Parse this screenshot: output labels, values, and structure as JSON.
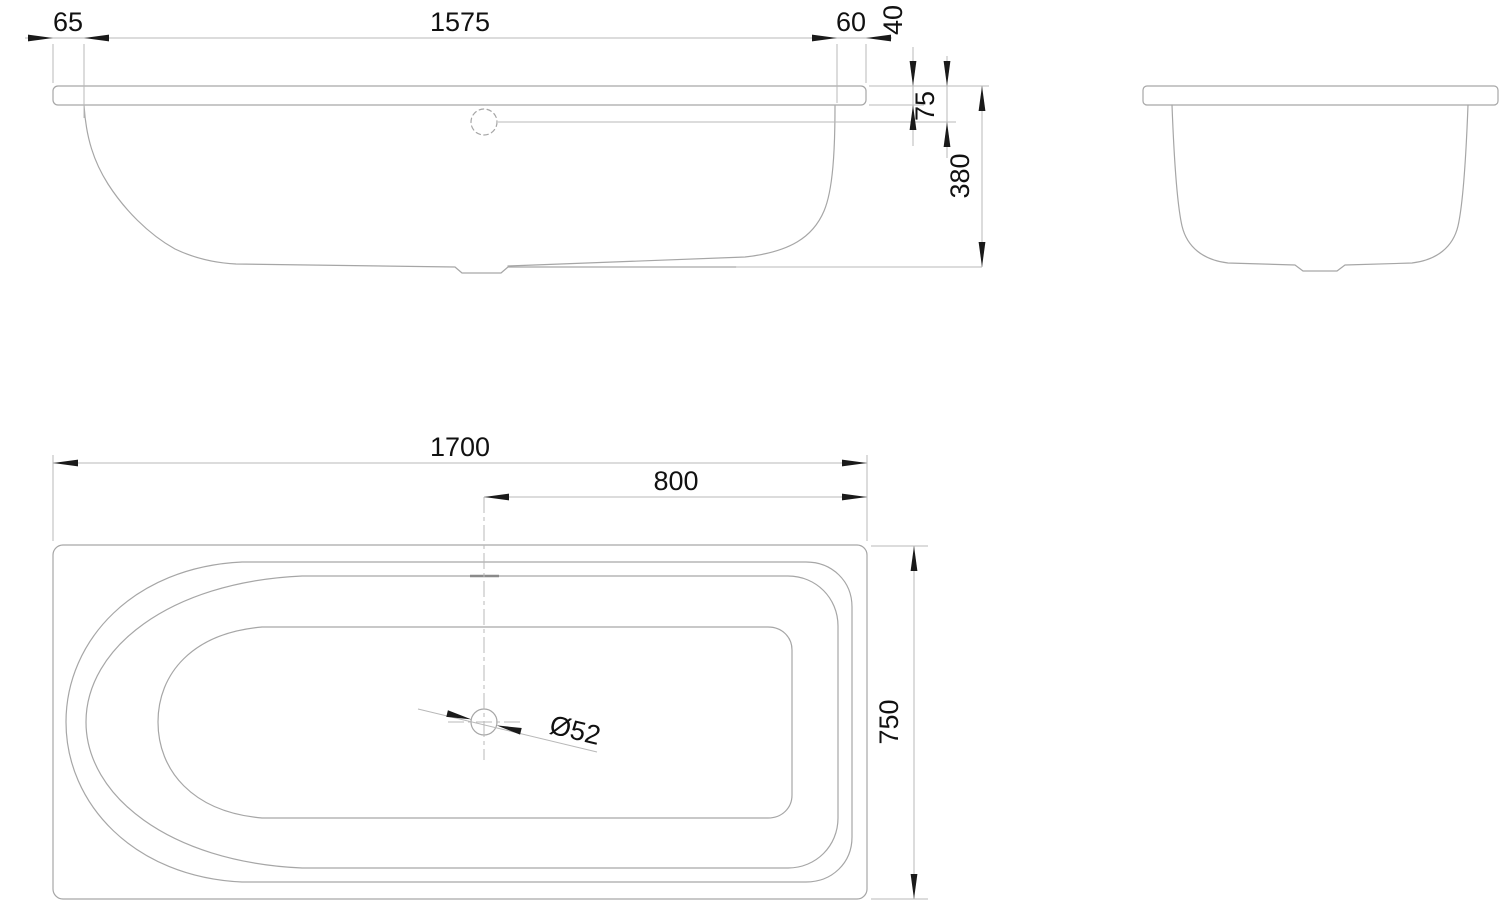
{
  "drawing": {
    "background": "#ffffff",
    "geometry_line_color": "#a6a6a6",
    "dimension_line_color": "#b8b8b8",
    "arrow_color": "#1a1a1a",
    "text_color": "#111111"
  },
  "dimensions": {
    "side_view": {
      "rim_overhang_left": "65",
      "body_length": "1575",
      "rim_overhang_right": "60",
      "rim_height": "40",
      "overflow_depth": "75",
      "overall_height": "380"
    },
    "plan_view": {
      "overall_length": "1700",
      "drain_offset": "800",
      "overall_width": "750",
      "drain_diameter": "Ø52"
    }
  }
}
